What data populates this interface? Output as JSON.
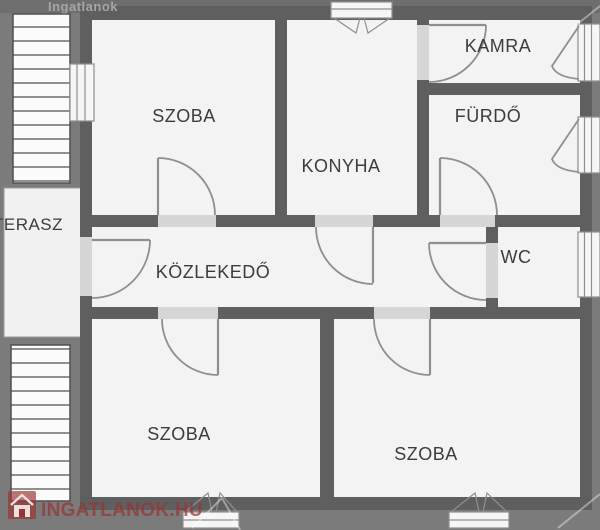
{
  "watermark": {
    "top_text": "Ingatlanok",
    "logo_text": "INGATLANOK.HU",
    "logo_icon": "house-icon"
  },
  "rooms": {
    "szoba_top": "SZOBA",
    "konyha": "KONYHA",
    "kamra": "KAMRA",
    "furdo": "FÜRDŐ",
    "terasz": "TERASZ",
    "kozlekedo": "KÖZLEKEDŐ",
    "wc": "WC",
    "szoba_bottom_left": "SZOBA",
    "szoba_bottom_right": "SZOBA"
  },
  "colors": {
    "background": "#7b7b7b",
    "wall": "#5f5f5f",
    "floor": "#f3f3f3",
    "doorway": "#d6d6d6",
    "accent": "#993333"
  }
}
